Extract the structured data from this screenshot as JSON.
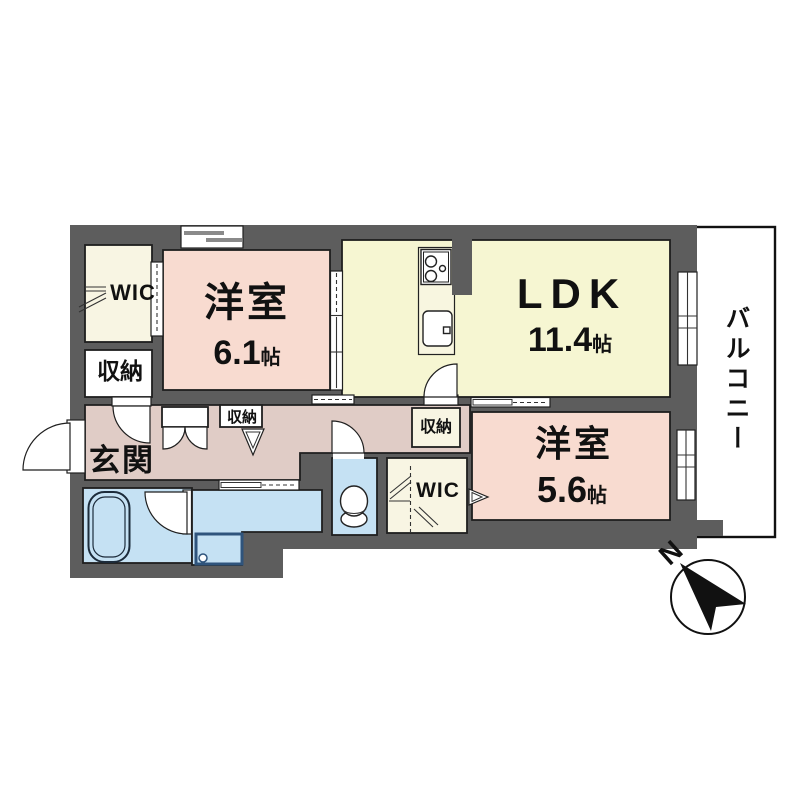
{
  "rooms": {
    "bedroom1": {
      "name": "洋室",
      "area": "6.1",
      "unit": "帖"
    },
    "ldk": {
      "name": "LDK",
      "area": "11.4",
      "unit": "帖"
    },
    "bedroom2": {
      "name": "洋室",
      "area": "5.6",
      "unit": "帖"
    },
    "entrance": {
      "name": "玄関"
    },
    "balcony": {
      "name": "バルコニー"
    },
    "wic_west": {
      "name": "WIC"
    },
    "wic_center": {
      "name": "WIC"
    },
    "closet_west": {
      "name": "収納"
    },
    "closet_hall": {
      "name": "収納"
    },
    "closet_center": {
      "name": "収納"
    }
  },
  "compass": {
    "north_label": "N"
  },
  "colors": {
    "wall": "#5d5d5d",
    "bedroom": "#f8dbd0",
    "ldk": "#f6f6d2",
    "closet": "#f8f5e3",
    "hall": "#e0ccc6",
    "wet": "#c5e1f3",
    "counter": "#f8f6e0",
    "white": "#ffffff"
  }
}
